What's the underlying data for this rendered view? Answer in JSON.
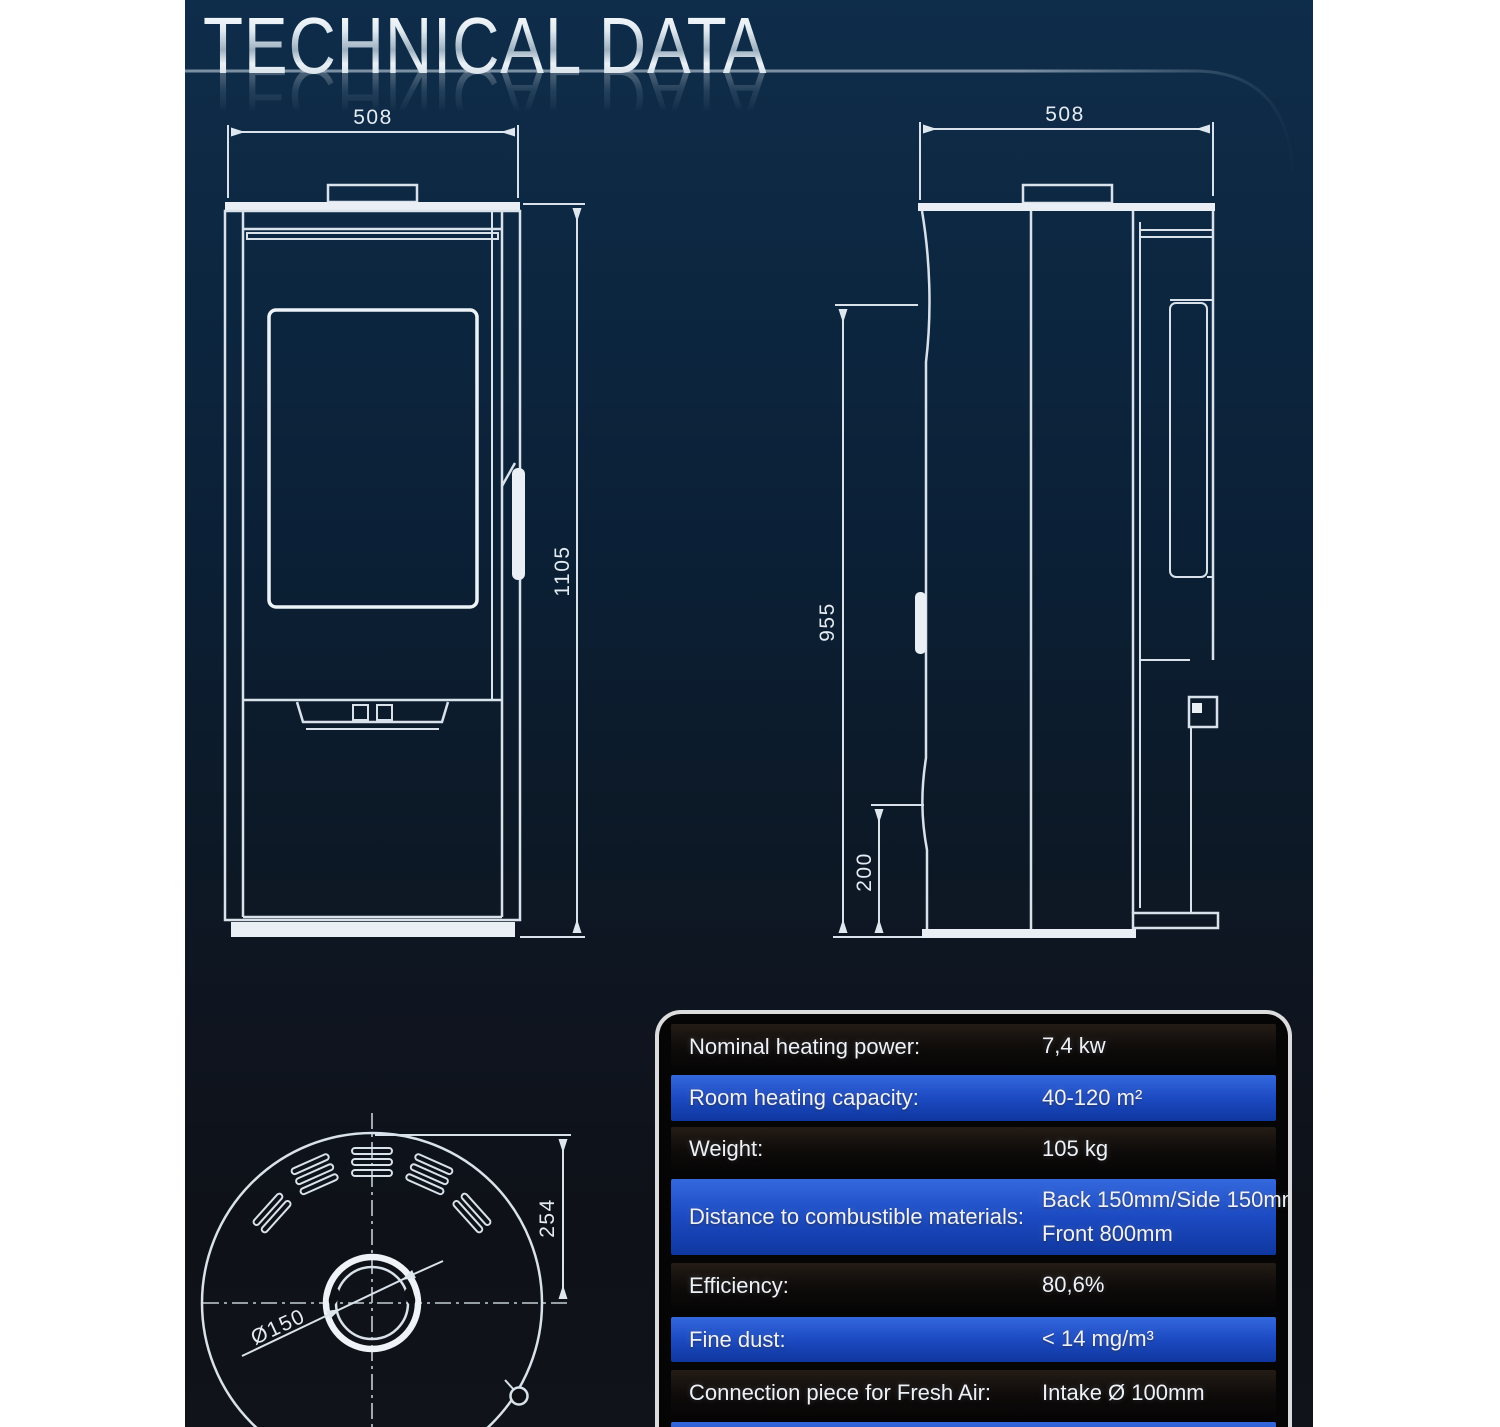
{
  "header": {
    "title": "TECHNICAL DATA"
  },
  "drawings": {
    "front_view": {
      "name": "front-view",
      "width_mm": "508",
      "height_mm": "1105"
    },
    "side_view": {
      "name": "side-view",
      "depth_mm": "508",
      "rear_height_mm": "955",
      "lower_edge_mm": "200"
    },
    "top_view": {
      "name": "top-view",
      "flue_diameter": "Ø150",
      "flue_center_offset_mm": "254"
    }
  },
  "table": {
    "rows": [
      {
        "label": "Nominal heating power:",
        "value": "7,4 kw"
      },
      {
        "label": "Room heating capacity:",
        "value": "40-120 m²"
      },
      {
        "label": "Weight:",
        "value": "105 kg"
      },
      {
        "label": "Distance to combustible materials:",
        "value": "Back 150mm/Side 150mm/",
        "value2": "Front 800mm"
      },
      {
        "label": "Efficiency:",
        "value": "80,6%"
      },
      {
        "label": "Fine dust:",
        "value": "< 14 mg/m³"
      },
      {
        "label": "Connection piece for Fresh Air:",
        "value": "Intake Ø 100mm"
      }
    ]
  },
  "colors": {
    "row_blue": "#1c4ac2",
    "row_dark": "#0e0b0a",
    "drawing_line": "#d9e2ea",
    "page_top": "#0e2d4a",
    "page_bottom": "#10131a"
  }
}
